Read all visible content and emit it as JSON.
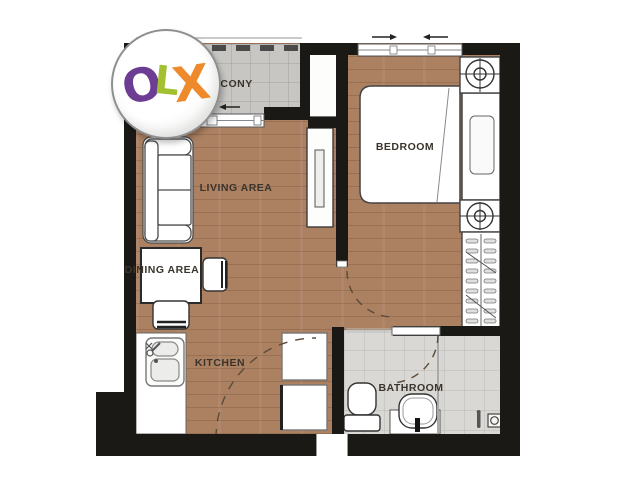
{
  "watermark": {
    "brand": "OLX",
    "letters": [
      {
        "char": "O",
        "color": "#6d3d94"
      },
      {
        "char": "L",
        "color": "#a2c030"
      },
      {
        "char": "X",
        "color": "#ee8a2b"
      }
    ]
  },
  "rooms": {
    "balcony": {
      "label": "BALCONY"
    },
    "living": {
      "label": "LIVING AREA"
    },
    "bedroom": {
      "label": "BEDROOM"
    },
    "dining": {
      "label": "DINING AREA"
    },
    "kitchen": {
      "label": "KITCHEN"
    },
    "bathroom": {
      "label": "BATHROOM"
    }
  },
  "colors": {
    "wall": "#1b1916",
    "wood_floor": "#ac8162",
    "balcony_tile": "#c7c6c2",
    "bathroom_tile": "#d9d8d4",
    "label_text": "#3b342c",
    "olx_o": "#6d3d94",
    "olx_l": "#a2c030",
    "olx_x": "#ee8a2b"
  }
}
